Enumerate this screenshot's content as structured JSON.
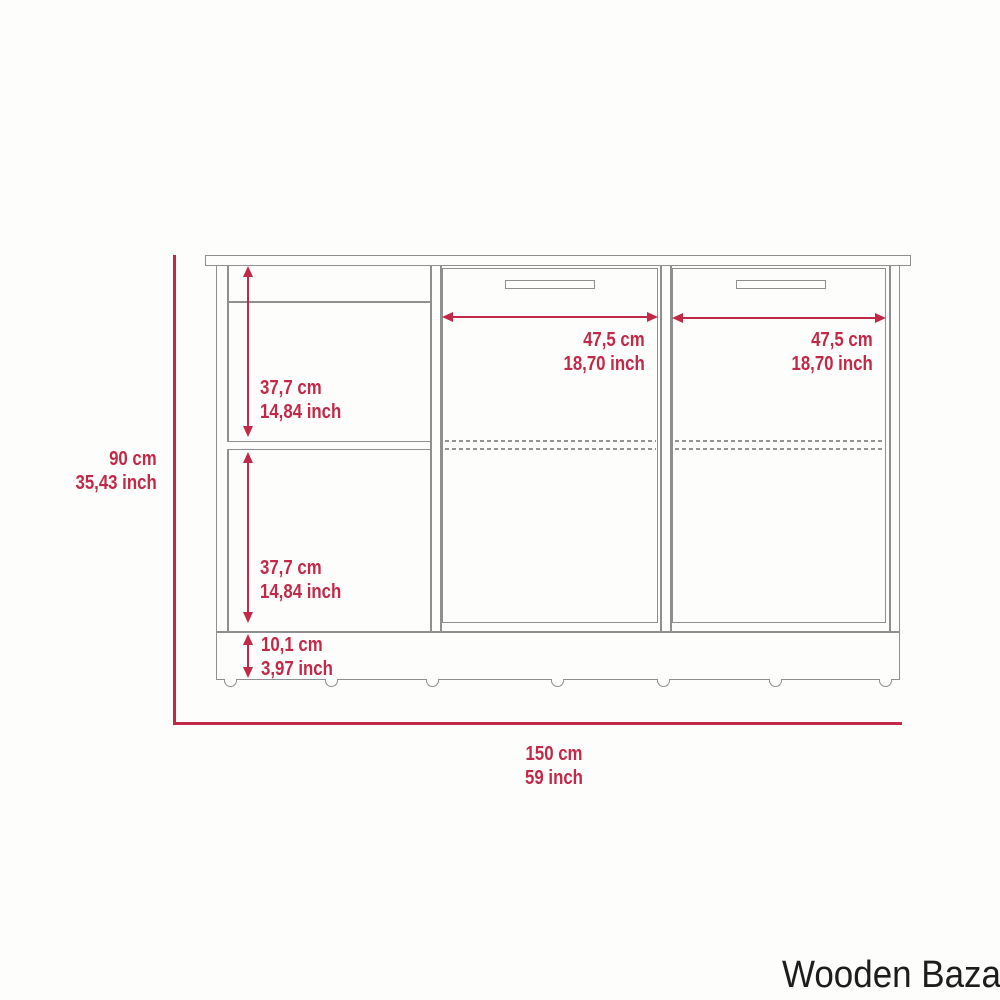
{
  "brand": "Wooden Bazar",
  "colors": {
    "dimension_red": "#c22848",
    "outline_gray": "#8f8f8f",
    "background": "#fdfdfb",
    "brand_text": "#1d1d1d"
  },
  "diagram": {
    "type": "furniture-dimension-diagram",
    "object": "sideboard cabinet with left open shelves and two doors",
    "labels": {
      "overall_height": {
        "cm": "90 cm",
        "inch": "35,43 inch"
      },
      "overall_width": {
        "cm": "150 cm",
        "inch": "59 inch"
      },
      "upper_shelf_height": {
        "cm": "37,7 cm",
        "inch": "14,84 inch"
      },
      "lower_shelf_height": {
        "cm": "37,7 cm",
        "inch": "14,84 inch"
      },
      "base_height": {
        "cm": "10,1 cm",
        "inch": "3,97 inch"
      },
      "middle_door_width": {
        "cm": "47,5 cm",
        "inch": "18,70 inch"
      },
      "right_door_width": {
        "cm": "47,5 cm",
        "inch": "18,70 inch"
      }
    }
  }
}
